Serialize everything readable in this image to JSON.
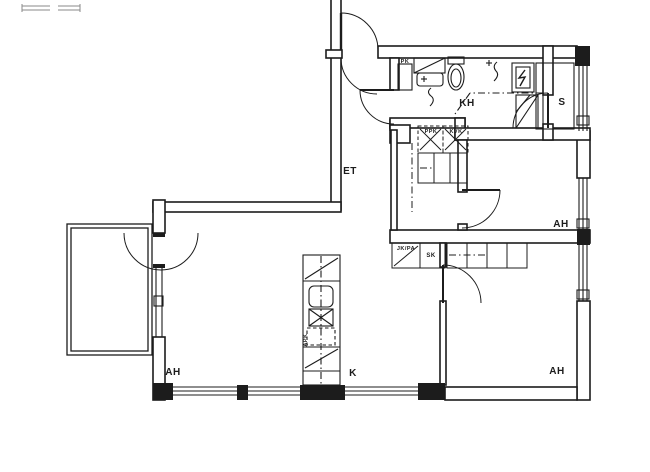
{
  "drawing": {
    "kind": "apartment floor plan, scanned black-and-white line drawing"
  },
  "rooms": {
    "et": "ET",
    "kh": "KH",
    "s": "S",
    "ah_upper_right": "AH",
    "ah_lower_right": "AH",
    "ah_left": "AH",
    "k": "K"
  },
  "fixtures": {
    "sk": "SK",
    "jk_pa": "JK/PA",
    "ppk": "PPK",
    "kvk": "KVK",
    "pk": "PK",
    "apk": "APK"
  },
  "colors": {
    "ink": "#1c1c1c",
    "paper": "#ffffff",
    "faint": "#8a8a8a"
  }
}
